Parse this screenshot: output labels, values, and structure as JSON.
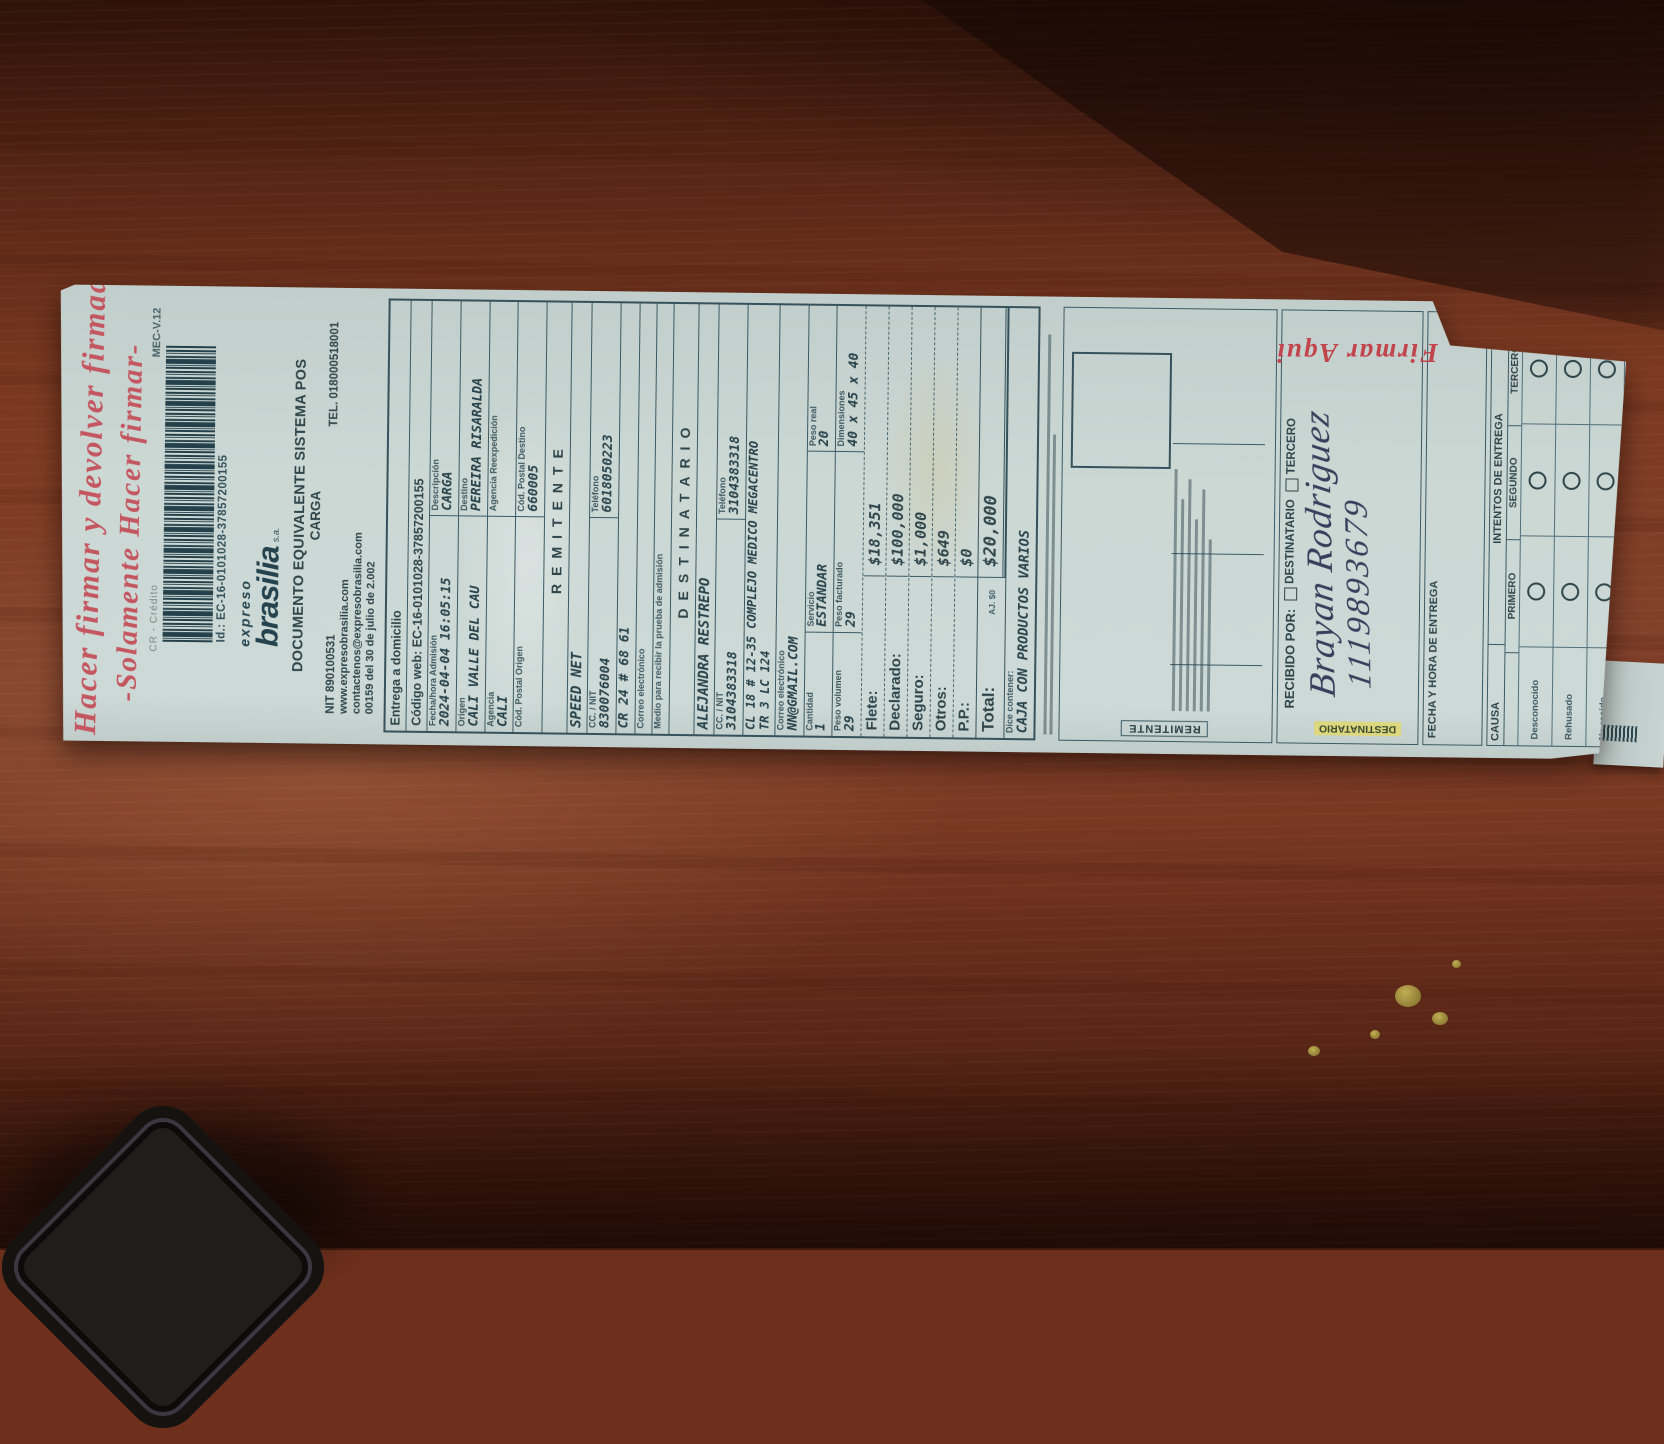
{
  "annotations": {
    "top_note_line1": "Hacer firmar y devolver firmada",
    "top_note_line2": "-Solamente Hacer firmar-",
    "sign_here": "Firmar Aqui",
    "received_name": "Brayan Rodriguez",
    "received_id": "1119893679"
  },
  "header": {
    "payment_type": "CR - Crédito",
    "version": "MEC-V.12",
    "barcode_id": "Id.: EC-16-0101028-37857200155",
    "brand_top": "expreso",
    "brand_main": "brasilia",
    "brand_suffix": "s.a.",
    "doc_title_1": "DOCUMENTO EQUIVALENTE SISTEMA POS",
    "doc_title_2": "CARGA",
    "nit": "NIT 890100531",
    "tel": "TEL. 018000518001",
    "web": "www.expresobrasilia.com",
    "email": "contactenos@expresobrasilia.com",
    "resolution": "00159 del 30 de julio de 2.002"
  },
  "shipment": {
    "delivery_type": "Entrega a domicilio",
    "web_code": "Código web: EC-16-0101028-37857200155",
    "fecha_label": "Fecha/hora Admisión",
    "fecha": "2024-04-04 16:05:15",
    "desc_label": "Descripción",
    "desc": "CARGA",
    "origen_label": "Origen",
    "origen": "CALI VALLE DEL CAU",
    "destino_label": "Destino",
    "destino": "PEREIRA RISARALDA",
    "agencia_label": "Agencia",
    "agencia": "CALI",
    "reexp_label": "Agencia Reexpedición",
    "reexp": "",
    "cp_origen_label": "Cód. Postal Origen",
    "cp_origen": "",
    "cp_destino_label": "Cód. Postal Destino",
    "cp_destino": "660005"
  },
  "remitente": {
    "title": "REMITENTE",
    "name": "SPEED NET",
    "id_label": "CC. / NIT",
    "id": "830076004",
    "tel_label": "Teléfono",
    "tel": "6018050223",
    "address": "CR 24 # 68 61",
    "email_label": "Correo electrónico",
    "email": "",
    "medio_label": "Medio para recibir la prueba de admisión"
  },
  "destinatario": {
    "title": "DESTINATARIO",
    "name": "ALEJANDRA RESTREPO",
    "id_label": "CC. / NIT",
    "id": "3104383318",
    "tel_label": "Teléfono",
    "tel": "3104383318",
    "address1": "CL 18 # 12-35 COMPLEJO MEDICO MEGACENTRO",
    "address2": "TR 3 LC 124",
    "email_label": "Correo electrónico",
    "email": "NN@GMAIL.COM"
  },
  "package": {
    "cantidad_label": "Cantidad",
    "cantidad": "1",
    "servicio_label": "Servicio",
    "servicio": "ESTANDAR",
    "peso_real_label": "Peso real",
    "peso_real": "20",
    "peso_vol_label": "Peso volumen",
    "peso_vol": "29",
    "peso_fact_label": "Peso facturado",
    "peso_fact": "29",
    "dim_label": "Dimensiones",
    "dim": "40 x 45 x 40"
  },
  "charges": [
    {
      "label": "Flete:",
      "value": "$18,351"
    },
    {
      "label": "Declarado:",
      "value": "$100,000"
    },
    {
      "label": "Seguro:",
      "value": "$1,000"
    },
    {
      "label": "Otros:",
      "value": "$649"
    },
    {
      "label": "P.P.:",
      "value": "$0"
    }
  ],
  "total": {
    "label": "Total:",
    "adjust": "AJ. $0",
    "value": "$20,000"
  },
  "contents": {
    "label": "Dice contener:",
    "value": "CAJA CON PRODUCTOS VARIOS"
  },
  "signature": {
    "side_label": "REMITENTE"
  },
  "received": {
    "label": "RECIBIDO POR:",
    "option1": "DESTINATARIO",
    "option2": "TERCERO",
    "side_label": "DESTINATARIO"
  },
  "delivery": {
    "fecha_label": "FECHA Y HORA DE ENTREGA",
    "intentos_label": "INTENTOS DE ENTREGA",
    "causa_label": "CAUSA",
    "attempts": [
      "PRIMERO",
      "SEGUNDO",
      "TERCERO"
    ],
    "causes": [
      "Desconocido",
      "Rehusado",
      "No reside",
      "No reclamado",
      "Dir errada",
      "Otros"
    ]
  }
}
